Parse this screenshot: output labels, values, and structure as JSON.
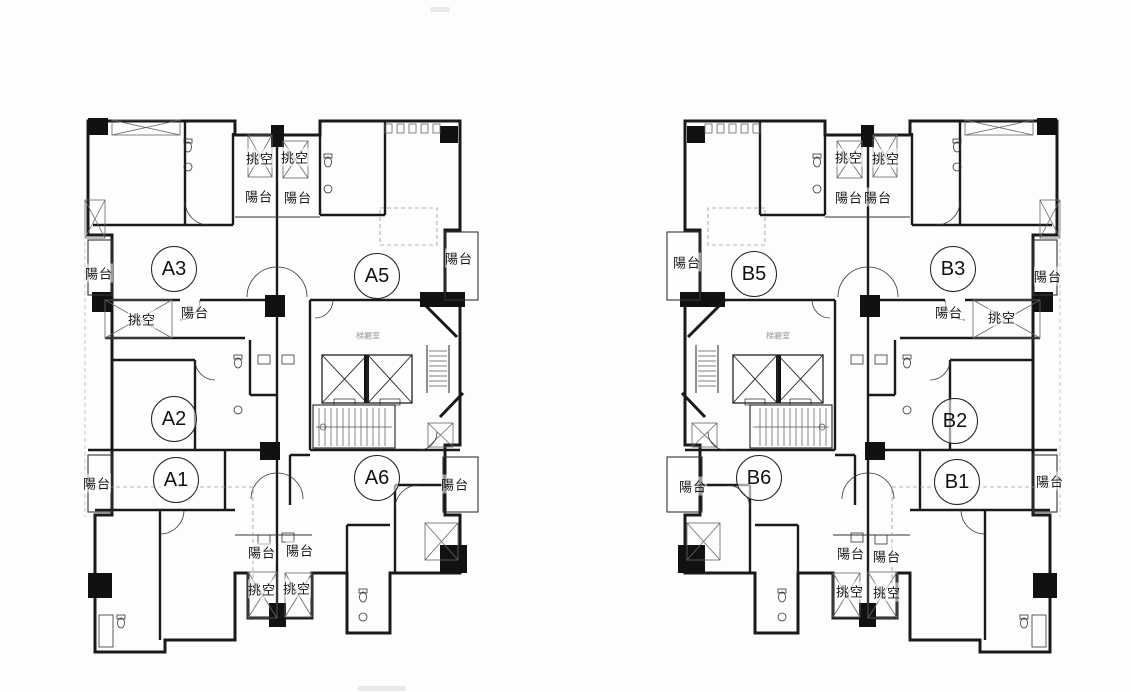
{
  "drawing": {
    "type": "residential-tower-typical-floor-plan",
    "buildings": [
      {
        "name": "Building A",
        "units": [
          {
            "label": "A3",
            "x": 174,
            "y": 269
          },
          {
            "label": "A5",
            "x": 377,
            "y": 276
          },
          {
            "label": "A2",
            "x": 174,
            "y": 419
          },
          {
            "label": "A1",
            "x": 176,
            "y": 480
          },
          {
            "label": "A6",
            "x": 377,
            "y": 478
          }
        ],
        "annotations": [
          {
            "text": "挑空",
            "x": 260,
            "y": 158
          },
          {
            "text": "挑空",
            "x": 295,
            "y": 157
          },
          {
            "text": "陽台",
            "x": 259,
            "y": 196
          },
          {
            "text": "陽台",
            "x": 298,
            "y": 197
          },
          {
            "text": "陽台",
            "x": 99,
            "y": 273
          },
          {
            "text": "挑空",
            "x": 142,
            "y": 319
          },
          {
            "text": "陽台",
            "x": 195,
            "y": 312
          },
          {
            "text": "陽台",
            "x": 459,
            "y": 258
          },
          {
            "text": "陽台",
            "x": 97,
            "y": 483
          },
          {
            "text": "陽台",
            "x": 455,
            "y": 484
          },
          {
            "text": "陽台",
            "x": 262,
            "y": 552
          },
          {
            "text": "陽台",
            "x": 300,
            "y": 550
          },
          {
            "text": "挑空",
            "x": 262,
            "y": 589
          },
          {
            "text": "挑空",
            "x": 297,
            "y": 588
          }
        ],
        "core_label": {
          "text": "梯廳室",
          "x": 368,
          "y": 336
        }
      },
      {
        "name": "Building B",
        "units": [
          {
            "label": "B5",
            "x": 754,
            "y": 274
          },
          {
            "label": "B3",
            "x": 953,
            "y": 269
          },
          {
            "label": "B2",
            "x": 955,
            "y": 421
          },
          {
            "label": "B6",
            "x": 759,
            "y": 478
          },
          {
            "label": "B1",
            "x": 957,
            "y": 482
          }
        ],
        "annotations": [
          {
            "text": "挑空",
            "x": 849,
            "y": 157
          },
          {
            "text": "挑空",
            "x": 886,
            "y": 158
          },
          {
            "text": "陽台",
            "x": 849,
            "y": 197
          },
          {
            "text": "陽台",
            "x": 878,
            "y": 197
          },
          {
            "text": "陽台",
            "x": 1048,
            "y": 276
          },
          {
            "text": "陽台",
            "x": 949,
            "y": 312
          },
          {
            "text": "挑空",
            "x": 1002,
            "y": 317
          },
          {
            "text": "陽台",
            "x": 687,
            "y": 262
          },
          {
            "text": "陽台",
            "x": 693,
            "y": 486
          },
          {
            "text": "陽台",
            "x": 1050,
            "y": 481
          },
          {
            "text": "陽台",
            "x": 851,
            "y": 553
          },
          {
            "text": "陽台",
            "x": 887,
            "y": 556
          },
          {
            "text": "挑空",
            "x": 850,
            "y": 591
          },
          {
            "text": "挑空",
            "x": 887,
            "y": 592
          }
        ],
        "core_label": {
          "text": "梯廳室",
          "x": 778,
          "y": 336
        }
      }
    ],
    "term_glossary": {
      "陽台": "balcony",
      "挑空": "void / double-height opening",
      "梯廳室": "elevator hall"
    }
  }
}
